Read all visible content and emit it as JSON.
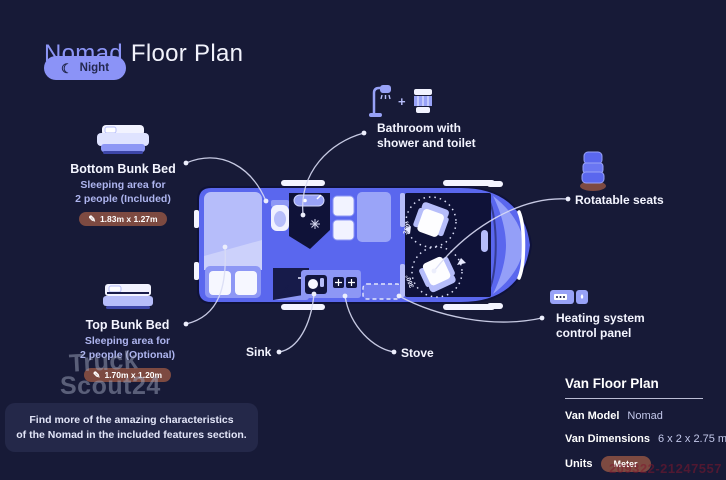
{
  "header": {
    "brand": "Nomad",
    "title": "Floor Plan",
    "mode_label": "Night"
  },
  "icons": {
    "moon": "☾",
    "pencil": "✎",
    "plus": "+"
  },
  "features": {
    "bottom_bunk": {
      "title": "Bottom Bunk Bed",
      "desc1": "Sleeping area for",
      "desc2": "2 people (Included)",
      "dimensions": "1.83m x 1.27m"
    },
    "top_bunk": {
      "title": "Top Bunk Bed",
      "desc1": "Sleeping area for",
      "desc2": "2 people (Optional)",
      "dimensions": "1.70m x 1.20m"
    },
    "bathroom": {
      "label1": "Bathroom with",
      "label2": "shower and toilet"
    },
    "rotatable_seats": {
      "label": "Rotatable seats"
    },
    "heating": {
      "label1": "Heating system",
      "label2": "control panel"
    },
    "sink": {
      "label": "Sink"
    },
    "stove": {
      "label": "Stove"
    }
  },
  "van": {
    "rotation_label": "360°"
  },
  "note": {
    "line1": "Find more of the amazing characteristics",
    "line2": "of the Nomad in the included features section."
  },
  "spec_panel": {
    "title": "Van Floor Plan",
    "model_label": "Van Model",
    "model_value": "Nomad",
    "dimensions_label": "Van Dimensions",
    "dimensions_value": "6 x 2 x 2.75 m",
    "units_label": "Units",
    "units_value": "Meter"
  },
  "watermark": {
    "line1": "Truck",
    "line2": "Scout24",
    "listing_id": "209322-21247557"
  },
  "colors": {
    "background": "#171a37",
    "accent": "#8d97f5",
    "van_body": "#5a67ee",
    "badge": "#7d4a41",
    "night_pill": "#8b93f7",
    "panel": "#242849"
  }
}
